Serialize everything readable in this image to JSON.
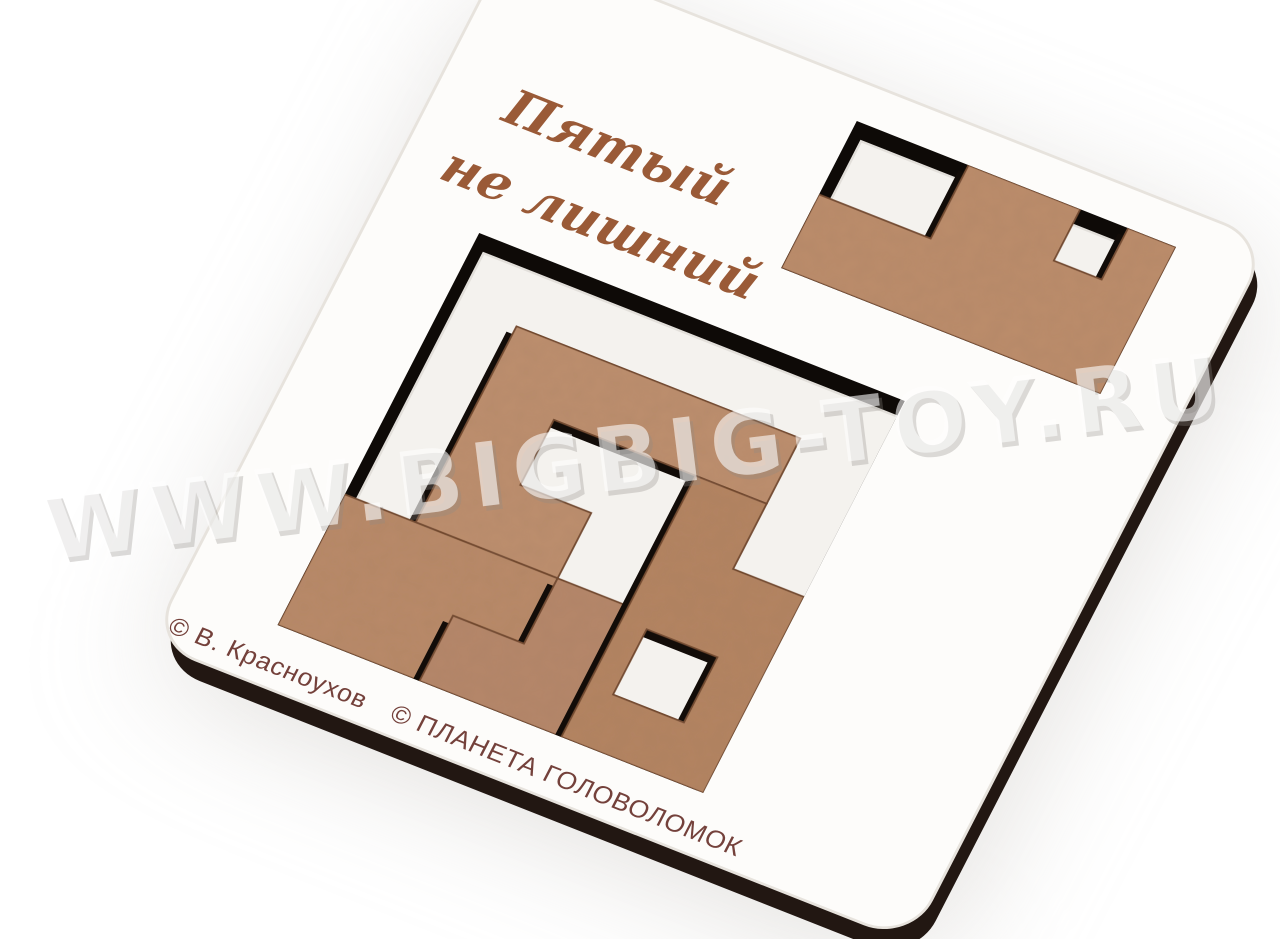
{
  "product": {
    "title_line1": "Пятый",
    "title_line2": "не лишний",
    "credit": "© В. Красноухов",
    "publisher": "© ПЛАНЕТА  ГОЛОВОЛОМОК",
    "watermark": "WWW.BIGBIG-TOY.RU",
    "piece_count": 5,
    "object": "wooden tray puzzle with brown MDF pieces, photographed at an angle on white background"
  },
  "colors": {
    "background": "#ffffff",
    "board_face": "#fdfcfa",
    "board_edge_line": "#e7e3dd",
    "board_side": "#221712",
    "board_side_dark": "#17100c",
    "hole_dark": "#0e0a07",
    "tray_floor": "#f4f2ee",
    "floor_shade": "#e2dfda",
    "piece": "#b98a69",
    "piece_alt1": "#b48462",
    "piece_alt2": "#bd8f6e",
    "piece_alt3": "#b6876a",
    "piece_alt4": "#bc8d6c",
    "piece_outline": "#6e452c",
    "piece_shadow": "#120c08",
    "cast_shadow": "#c9c5c0",
    "title_text": "#9a5a37",
    "credit_text": "#74413b"
  },
  "scene": {
    "board": {
      "w": 100,
      "h": 100,
      "corner_radius": 6
    },
    "floor_offset": [
      1.6,
      2.2
    ],
    "piece_shadow_offset": [
      -0.8,
      1.1
    ],
    "trays": [
      {
        "id": "main",
        "origin": [
          13,
          36
        ],
        "unit": 9.3333,
        "cols": 6,
        "rows": 6
      },
      {
        "id": "small",
        "origin": [
          48,
          5
        ],
        "unit": 10.5,
        "cols": 4,
        "rows": 2
      }
    ],
    "pieces": [
      {
        "id": "piece-top-s",
        "tray": "main",
        "fill": "piece_alt2",
        "points": [
          [
            1,
            1
          ],
          [
            5,
            1
          ],
          [
            5,
            2
          ],
          [
            2,
            2
          ],
          [
            2,
            3
          ],
          [
            3,
            3
          ],
          [
            3,
            4
          ],
          [
            1,
            4
          ]
        ]
      },
      {
        "id": "piece-left-l",
        "tray": "main",
        "fill": "piece",
        "points": [
          [
            0,
            4
          ],
          [
            3,
            4
          ],
          [
            3,
            5
          ],
          [
            2,
            5
          ],
          [
            2,
            6
          ],
          [
            0,
            6
          ]
        ]
      },
      {
        "id": "piece-center-z",
        "tray": "main",
        "fill": "piece_alt3",
        "points": [
          [
            3,
            4
          ],
          [
            4,
            4
          ],
          [
            4,
            6
          ],
          [
            2,
            6
          ],
          [
            2,
            5
          ],
          [
            3,
            5
          ]
        ]
      },
      {
        "id": "piece-right-hook",
        "tray": "main",
        "fill": "piece_alt1",
        "points": [
          [
            4,
            2
          ],
          [
            5,
            2
          ],
          [
            5,
            3
          ],
          [
            6,
            3
          ],
          [
            6,
            6
          ],
          [
            4,
            6
          ]
        ],
        "hole": [
          [
            4.35,
            4.2
          ],
          [
            5.35,
            4.2
          ],
          [
            5.35,
            5.2
          ],
          [
            4.35,
            5.2
          ]
        ]
      },
      {
        "id": "piece-small-z",
        "tray": "small",
        "fill": "piece_alt4",
        "points": [
          [
            0,
            1
          ],
          [
            1.4,
            1
          ],
          [
            1.4,
            0
          ],
          [
            2.8,
            0
          ],
          [
            2.8,
            0.7
          ],
          [
            3.4,
            0.7
          ],
          [
            3.4,
            0
          ],
          [
            4,
            0
          ],
          [
            4,
            2
          ],
          [
            0,
            2
          ]
        ]
      }
    ]
  }
}
